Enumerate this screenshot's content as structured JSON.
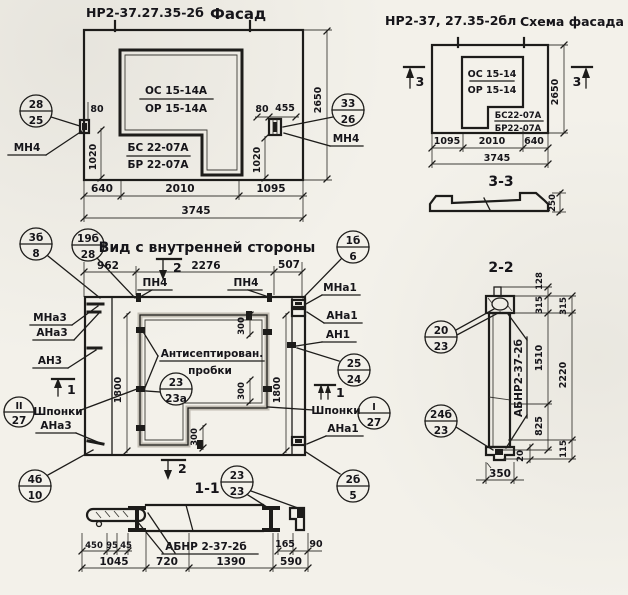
{
  "facade": {
    "title_code": "НР2-37.27.35-2б",
    "title_word": "Фасад",
    "window_mark": {
      "top": "ОС 15-14А",
      "bottom": "ОР 15-14А"
    },
    "panel_mark": {
      "top": "БС 22-07А",
      "bottom": "БР 22-07А"
    },
    "anchor_label": "МН4",
    "callout_left": {
      "top": "28",
      "bottom": "25"
    },
    "callout_right": {
      "top": "33",
      "bottom": "26"
    },
    "dims": {
      "left_offset": "80",
      "right_offset": "80",
      "right_width": "455",
      "anchor_height": "1020",
      "height": "2650",
      "bottom": [
        "640",
        "2010",
        "1095"
      ],
      "total": "3745"
    }
  },
  "schema": {
    "title_code": "НР2-37, 27.35-2бл",
    "title_word": "Схема фасада",
    "window_mark": {
      "top": "ОС 15-14",
      "bottom": "ОР 15-14"
    },
    "panel_mark": {
      "top": "БС22-07А",
      "bottom": "БР22-07А"
    },
    "section_mark": "3",
    "dims": {
      "height": "2650",
      "bottom": [
        "1095",
        "2010",
        "640"
      ],
      "total": "3745"
    },
    "section_3_3": {
      "title": "3-3",
      "thickness": "250"
    }
  },
  "inner_view": {
    "title": "Вид с внутренней стороны",
    "labels": {
      "pn4": "ПН4",
      "mna1": "МНа1",
      "ana1": "АНа1",
      "an1": "АН1",
      "mna3": "МНа3",
      "ana3": "АНа3",
      "an3": "АН3",
      "shponki": "Шпонки",
      "antiseptic_1": "Антисептирован.",
      "antiseptic_2": "пробки"
    },
    "markers": {
      "m1": "1",
      "m2": "2"
    },
    "callouts": {
      "c3b_8": {
        "top": "3б",
        "bottom": "8"
      },
      "c19b_28": {
        "top": "19б",
        "bottom": "28"
      },
      "c1b_6": {
        "top": "1б",
        "bottom": "6"
      },
      "c25_24": {
        "top": "25",
        "bottom": "24"
      },
      "cI_27": {
        "top": "I",
        "bottom": "27"
      },
      "cII_27": {
        "top": "II",
        "bottom": "27"
      },
      "c23_23a": {
        "top": "23",
        "bottom": "23а"
      },
      "c2b_5": {
        "top": "2б",
        "bottom": "5"
      },
      "c4b_10": {
        "top": "4б",
        "bottom": "10"
      }
    },
    "dims": {
      "top": [
        "962",
        "2276",
        "507"
      ],
      "opening_height": "1800",
      "plug_spacing": "300"
    }
  },
  "section_1_1": {
    "title": "1-1",
    "marker": "2",
    "callout": {
      "top": "23",
      "bottom": "23"
    },
    "product_label": "АБНР 2-37-2б",
    "dims": {
      "left": [
        "450",
        "95",
        "45"
      ],
      "right": [
        "165",
        "90"
      ],
      "bottom": [
        "1045",
        "720",
        "1390",
        "590"
      ]
    }
  },
  "section_2_2": {
    "title": "2-2",
    "callout_top": {
      "top": "20",
      "bottom": "23"
    },
    "callout_bottom": {
      "top": "24б",
      "bottom": "23"
    },
    "product_label": "АБНР2-37-2б",
    "dims": {
      "inner": [
        "128",
        "315",
        "1510",
        "825",
        "20"
      ],
      "outer": [
        "315",
        "2220",
        "115"
      ],
      "width": "350"
    }
  }
}
